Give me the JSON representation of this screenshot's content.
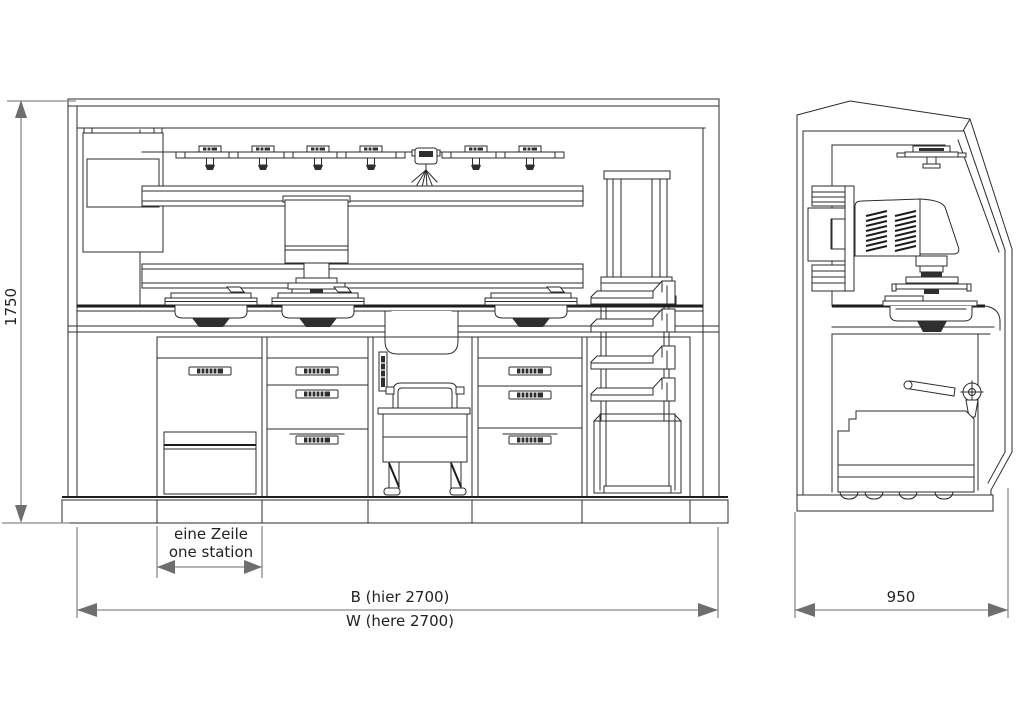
{
  "drawing": {
    "type": "technical-elevation-drawing",
    "views": {
      "front": "front elevation",
      "side": "side elevation"
    },
    "labels": {
      "height": "1750",
      "station_de": "eine Zeile",
      "station_en": "one station",
      "width_de": "B (hier 2700)",
      "width_en": "W (here 2700)",
      "depth": "950"
    },
    "colors": {
      "background": "#ffffff",
      "line": "#2b2b2b",
      "dimension_line": "#8a8a8a",
      "arrow": "#6e6e6e",
      "text": "#222222"
    }
  }
}
